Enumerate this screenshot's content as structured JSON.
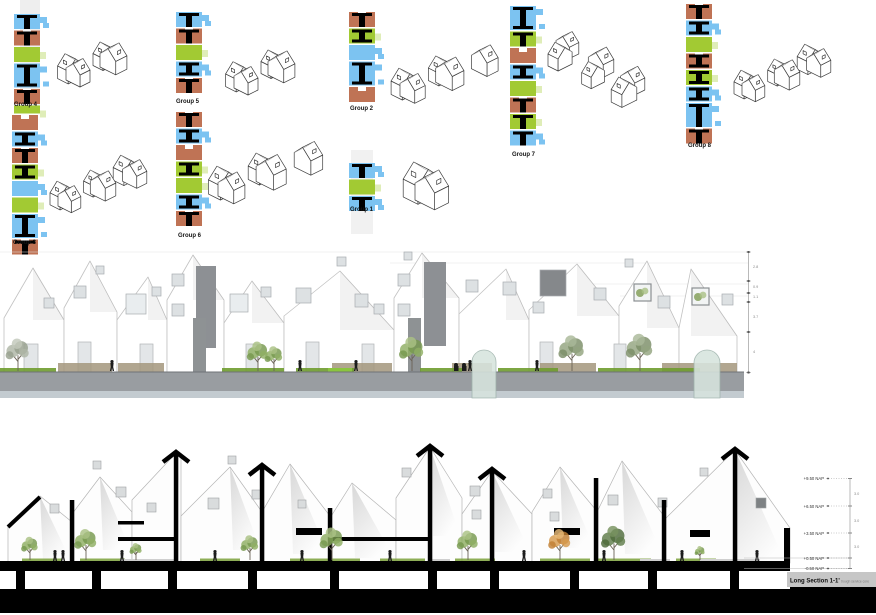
{
  "sheet": {
    "width": 876,
    "height": 615,
    "background": "#ffffff"
  },
  "palette": {
    "blue": "#7cc3f1",
    "green": "#a2ca33",
    "brown": "#bf7355",
    "black": "#000000",
    "ground_gray": "#999da1",
    "glass": "#d7e4de"
  },
  "groups": [
    {
      "label": "Group 4",
      "houses": 4,
      "strip": [
        [
          "blue",
          "T"
        ],
        [
          "brown",
          "T"
        ],
        [
          "green",
          ""
        ],
        [
          "blue",
          "I",
          "tall"
        ],
        [
          "brown",
          "T"
        ],
        [
          "green",
          "",
          "short"
        ]
      ]
    },
    {
      "label": "Group 5",
      "houses": 4,
      "strip": [
        [
          "blue",
          "T"
        ],
        [
          "brown",
          "T"
        ],
        [
          "green",
          ""
        ],
        [
          "blue",
          "I"
        ],
        [
          "brown",
          "T"
        ]
      ]
    },
    {
      "label": "Group 2",
      "houses": 5,
      "strip": [
        [
          "brown",
          "T"
        ],
        [
          "green",
          "I"
        ],
        [
          "blue",
          ""
        ],
        [
          "blue",
          "I",
          "tall"
        ],
        [
          "brown",
          ""
        ]
      ]
    },
    {
      "label": "Group 7",
      "houses": 6,
      "strip": [
        [
          "blue",
          "I",
          "tall"
        ],
        [
          "green",
          "T"
        ],
        [
          "brown",
          ""
        ],
        [
          "blue",
          "I"
        ],
        [
          "green",
          ""
        ],
        [
          "brown",
          "T"
        ],
        [
          "green",
          "T"
        ],
        [
          "blue",
          "T"
        ]
      ]
    },
    {
      "label": "Group 8",
      "houses": 6,
      "strip": [
        [
          "brown",
          "T"
        ],
        [
          "blue",
          "I"
        ],
        [
          "green",
          ""
        ],
        [
          "brown",
          "I"
        ],
        [
          "green",
          "I"
        ],
        [
          "blue",
          "I"
        ],
        [
          "blue",
          "T",
          "tall"
        ],
        [
          "brown",
          "T"
        ]
      ]
    },
    {
      "label": "Group 3",
      "houses": 6,
      "strip": [
        [
          "brown",
          ""
        ],
        [
          "blue",
          "I"
        ],
        [
          "brown",
          "T"
        ],
        [
          "green",
          "I"
        ],
        [
          "blue",
          ""
        ],
        [
          "green",
          ""
        ],
        [
          "blue",
          "I",
          "tall"
        ],
        [
          "brown",
          "T"
        ]
      ]
    },
    {
      "label": "Group 6",
      "houses": 5,
      "strip": [
        [
          "brown",
          "T"
        ],
        [
          "blue",
          "I"
        ],
        [
          "brown",
          ""
        ],
        [
          "green",
          "I"
        ],
        [
          "green",
          ""
        ],
        [
          "blue",
          "I"
        ],
        [
          "brown",
          "T"
        ]
      ]
    },
    {
      "label": "Group 1",
      "houses": 2,
      "strip": [
        [
          "blue",
          "T"
        ],
        [
          "green",
          ""
        ],
        [
          "blue",
          "T"
        ]
      ]
    }
  ],
  "elevation": {
    "dim_labels": [
      "2.8",
      "0.9",
      "1.1",
      "3.7",
      "4"
    ]
  },
  "section": {
    "levels": [
      "+9.50 NAP",
      "+6.50 NAP",
      "+3.50 NAP",
      "+0.50 NAP",
      "-0.50 NAP"
    ],
    "interval_labels": [
      "3.0",
      "3.0",
      "3.0"
    ],
    "title": "Long Section 1-1'",
    "subtitle": "trough service core"
  }
}
